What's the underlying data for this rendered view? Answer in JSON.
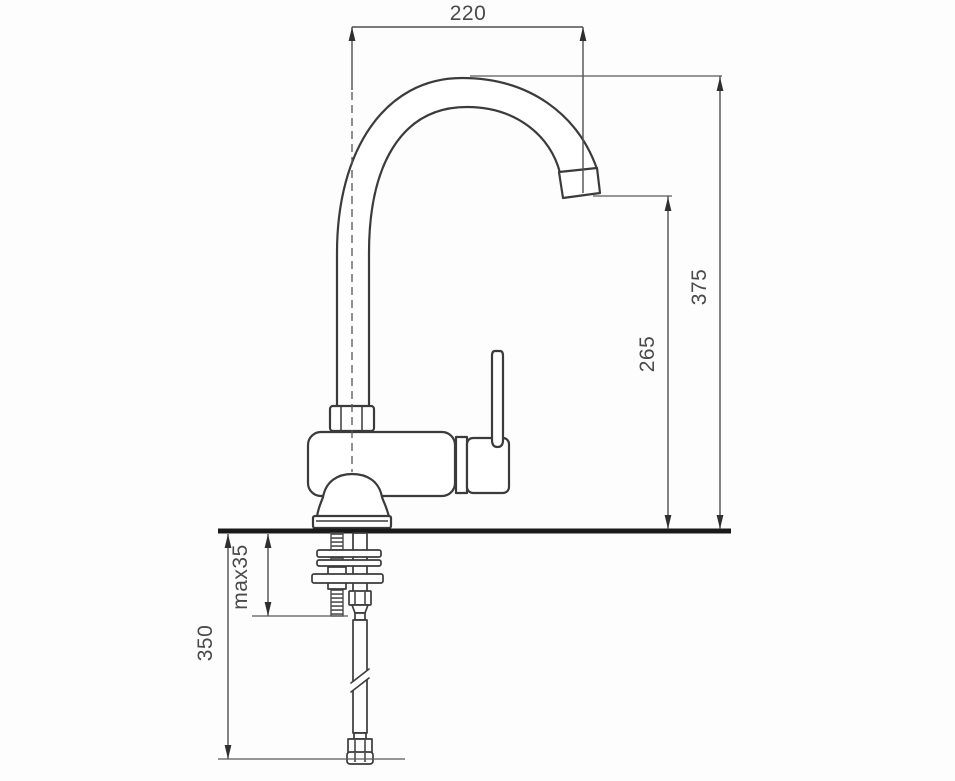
{
  "drawing": {
    "title": "kitchen-faucet-installation-dimension-drawing",
    "units": "mm",
    "dims": {
      "spout_reach": "220",
      "overall_height": "375",
      "spout_outlet_height": "265",
      "max_deck_thickness": "max35",
      "hose_length": "350"
    },
    "colors": {
      "outline": "#3b3b3b",
      "dimension_line": "#4f4f4f",
      "label_text": "#4a4a4a",
      "countertop": "#1a1a1a",
      "background": "#fdfdfd"
    }
  }
}
